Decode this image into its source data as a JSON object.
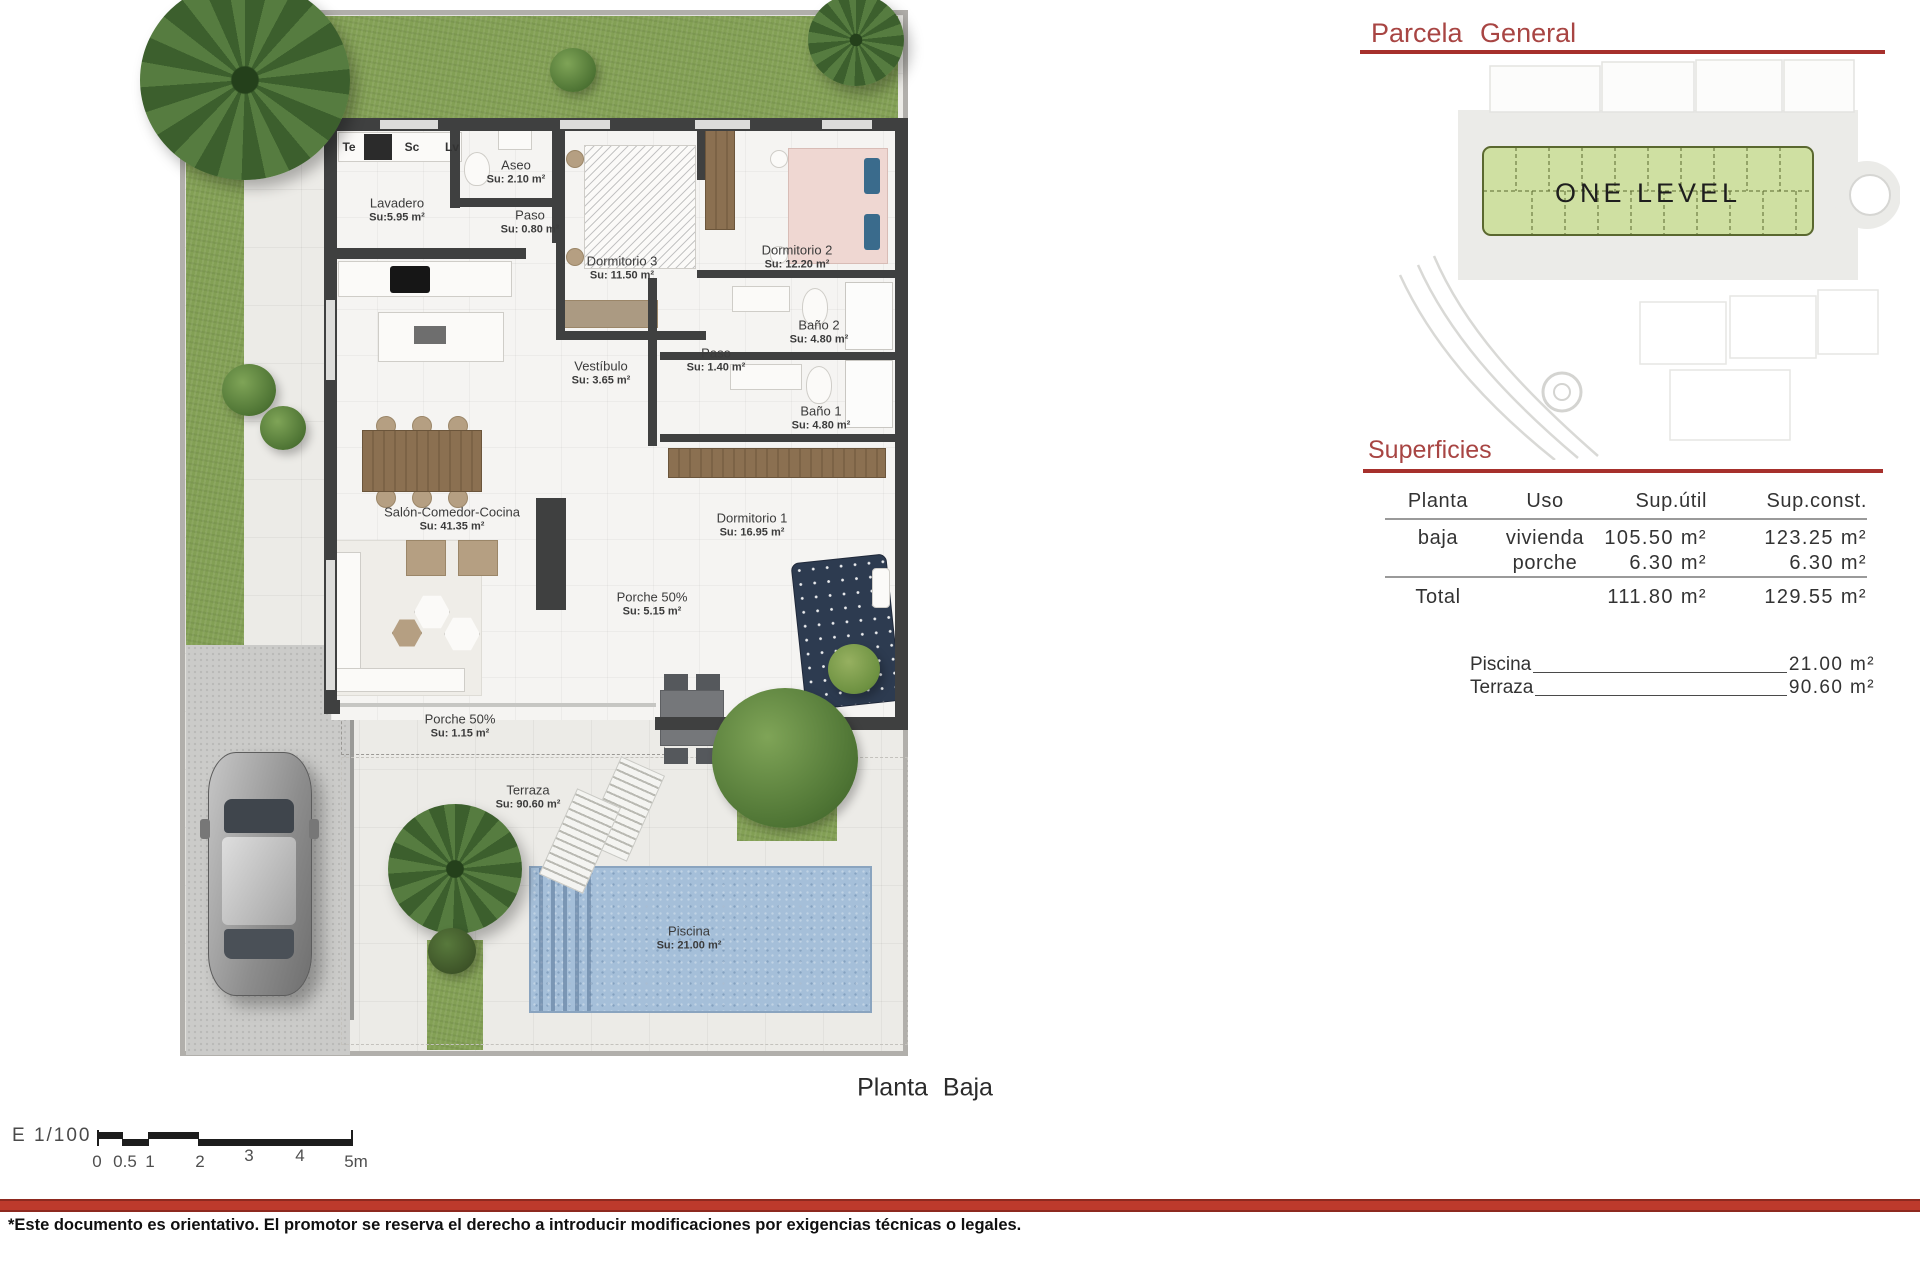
{
  "floor_plan": {
    "title": "Planta Baja",
    "appliances": {
      "te": "Te",
      "sc": "Sc",
      "lv": "Lv"
    },
    "rooms": [
      {
        "name": "Lavadero",
        "su": "Su:5.95 m²"
      },
      {
        "name": "Aseo",
        "su": "Su: 2.10 m²"
      },
      {
        "name": "Paso",
        "su": "Su: 0.80 m²"
      },
      {
        "name": "Dormitorio 3",
        "su": "Su: 11.50 m²"
      },
      {
        "name": "Dormitorio 2",
        "su": "Su: 12.20 m²"
      },
      {
        "name": "Baño 2",
        "su": "Su: 4.80 m²"
      },
      {
        "name": "Paso",
        "su": "Su: 1.40 m²"
      },
      {
        "name": "Baño 1",
        "su": "Su: 4.80 m²"
      },
      {
        "name": "Vestíbulo",
        "su": "Su: 3.65 m²"
      },
      {
        "name": "Salón-Comedor-Cocina",
        "su": "Su: 41.35 m²"
      },
      {
        "name": "Dormitorio 1",
        "su": "Su: 16.95 m²"
      },
      {
        "name": "Porche 50%",
        "su": "Su: 5.15 m²"
      },
      {
        "name": "Porche 50%",
        "su": "Su: 1.15 m²"
      },
      {
        "name": "Terraza",
        "su": "Su: 90.60 m²"
      },
      {
        "name": "Piscina",
        "su": "Su: 21.00 m²"
      }
    ]
  },
  "parcela": {
    "title": "Parcela General",
    "band_label": "ONE LEVEL"
  },
  "superficies": {
    "title": "Superficies",
    "headers": [
      "Planta",
      "Uso",
      "Sup.útil",
      "Sup.const."
    ],
    "rows": [
      {
        "planta": "baja",
        "uso": "vivienda",
        "util": "105.50 m²",
        "const": "123.25 m²"
      },
      {
        "planta": "",
        "uso": "porche",
        "util": "6.30 m²",
        "const": "6.30 m²"
      }
    ],
    "total": {
      "label": "Total",
      "util": "111.80 m²",
      "const": "129.55 m²"
    },
    "extras": [
      {
        "label": "Piscina",
        "value": "21.00 m²"
      },
      {
        "label": "Terraza",
        "value": "90.60 m²"
      }
    ]
  },
  "scale_bar": {
    "label": "E 1/100",
    "ticks": [
      "0",
      "0.5",
      "1",
      "2",
      "3",
      "4",
      "5m"
    ]
  },
  "footer": {
    "disclaimer": "*Este documento es orientativo. El promotor se reserva el derecho a introducir modificaciones por exigencias técnicas o legales."
  },
  "colors": {
    "accent_red": "#a84543",
    "line_red": "#a6302c",
    "wall": "#3f4040",
    "grass": "#83a055",
    "parcel_green": "#cfe0a2",
    "pool_blue": "#a5bfd9"
  }
}
